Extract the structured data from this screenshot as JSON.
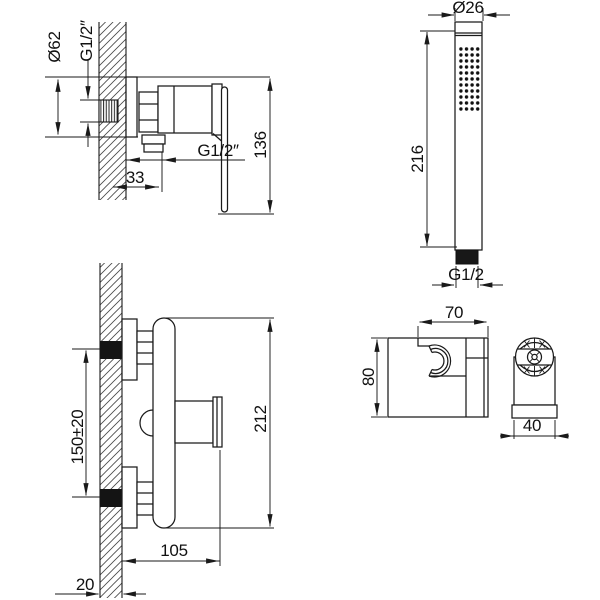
{
  "drawing_title": "Shower mixer installation drawing",
  "colors": {
    "background": "#ffffff",
    "line": "#1a1a1a"
  },
  "views": {
    "valve_side": {
      "name": "shut-off valve side view",
      "labels": {
        "flange_diameter": "Ø62",
        "inlet_thread": "G1/2″",
        "outlet_offset": "33",
        "outlet_thread": "G1/2″",
        "overall_height": "136"
      }
    },
    "hand_shower": {
      "name": "hand shower",
      "labels": {
        "head_diameter": "Ø26",
        "length": "216",
        "connector_thread": "G1/2"
      }
    },
    "mixer_front": {
      "name": "mixer body wall-mounted view",
      "labels": {
        "pipe_spacing": "150±20",
        "body_height": "212",
        "depth": "105",
        "wall_thickness": "20"
      }
    },
    "bracket": {
      "name": "shower holder bracket",
      "labels": {
        "width": "70",
        "height": "80",
        "depth": "40"
      }
    }
  }
}
